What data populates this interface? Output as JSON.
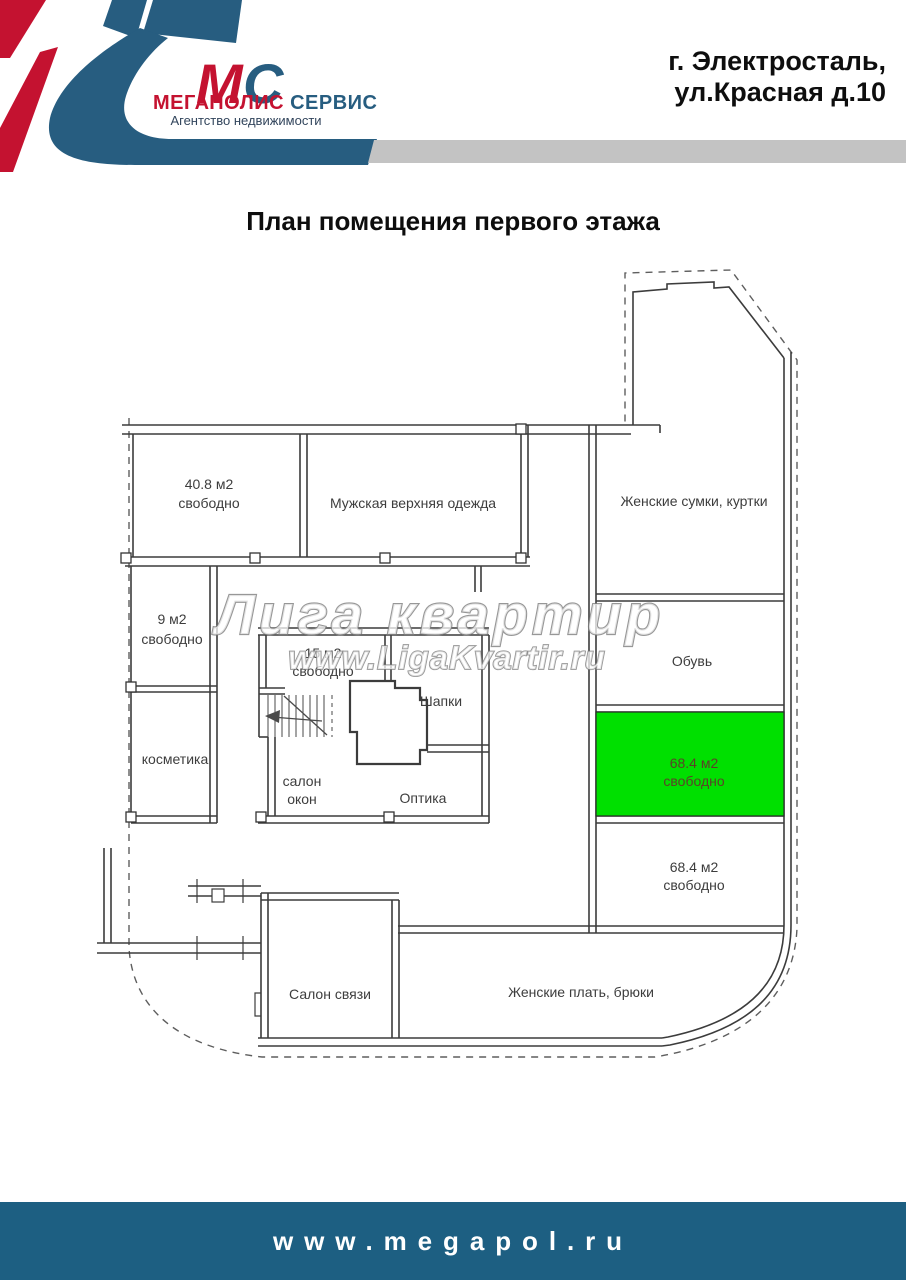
{
  "header": {
    "logo": {
      "monogram_m": "М",
      "monogram_c": "С",
      "brand_red": "МЕГАПОЛИС",
      "brand_blue": "СЕРВИС",
      "tagline": "Агентство недвижимости"
    },
    "address_line1": "г. Электросталь,",
    "address_line2": "ул.Красная д.10"
  },
  "title": "План помещения первого этажа",
  "watermark": {
    "line1": "Лига квартир",
    "line2": "www.LigaKvartir.ru"
  },
  "rooms": {
    "r408": {
      "line1": "40.8 м2",
      "line2": "свободно"
    },
    "mens_outerwear": "Мужская верхняя одежда",
    "womens_bags": "Женские сумки, куртки",
    "r9": {
      "line1": "9 м2",
      "line2": "свободно"
    },
    "cosmetics": "косметика",
    "r15": {
      "line1": "15 м2",
      "line2": "свободно"
    },
    "hats": "Шапки",
    "window_salon": {
      "line1": "салон",
      "line2": "окон"
    },
    "optics": "Оптика",
    "shoes": "Обувь",
    "green684": {
      "line1": "68.4 м2",
      "line2": "свободно"
    },
    "r684": {
      "line1": "68.4 м2",
      "line2": "свободно"
    },
    "phone_salon": "Салон связи",
    "womens_dresses": "Женские плать, брюки"
  },
  "footer": {
    "url": "www.megapol.ru"
  },
  "colors": {
    "accent_red": "#c41230",
    "accent_blue": "#275d80",
    "footer_bg": "#1d5f82",
    "gray_bar": "#c3c3c3",
    "highlight_green": "#00e000",
    "green_label_text": "#5b4228"
  }
}
